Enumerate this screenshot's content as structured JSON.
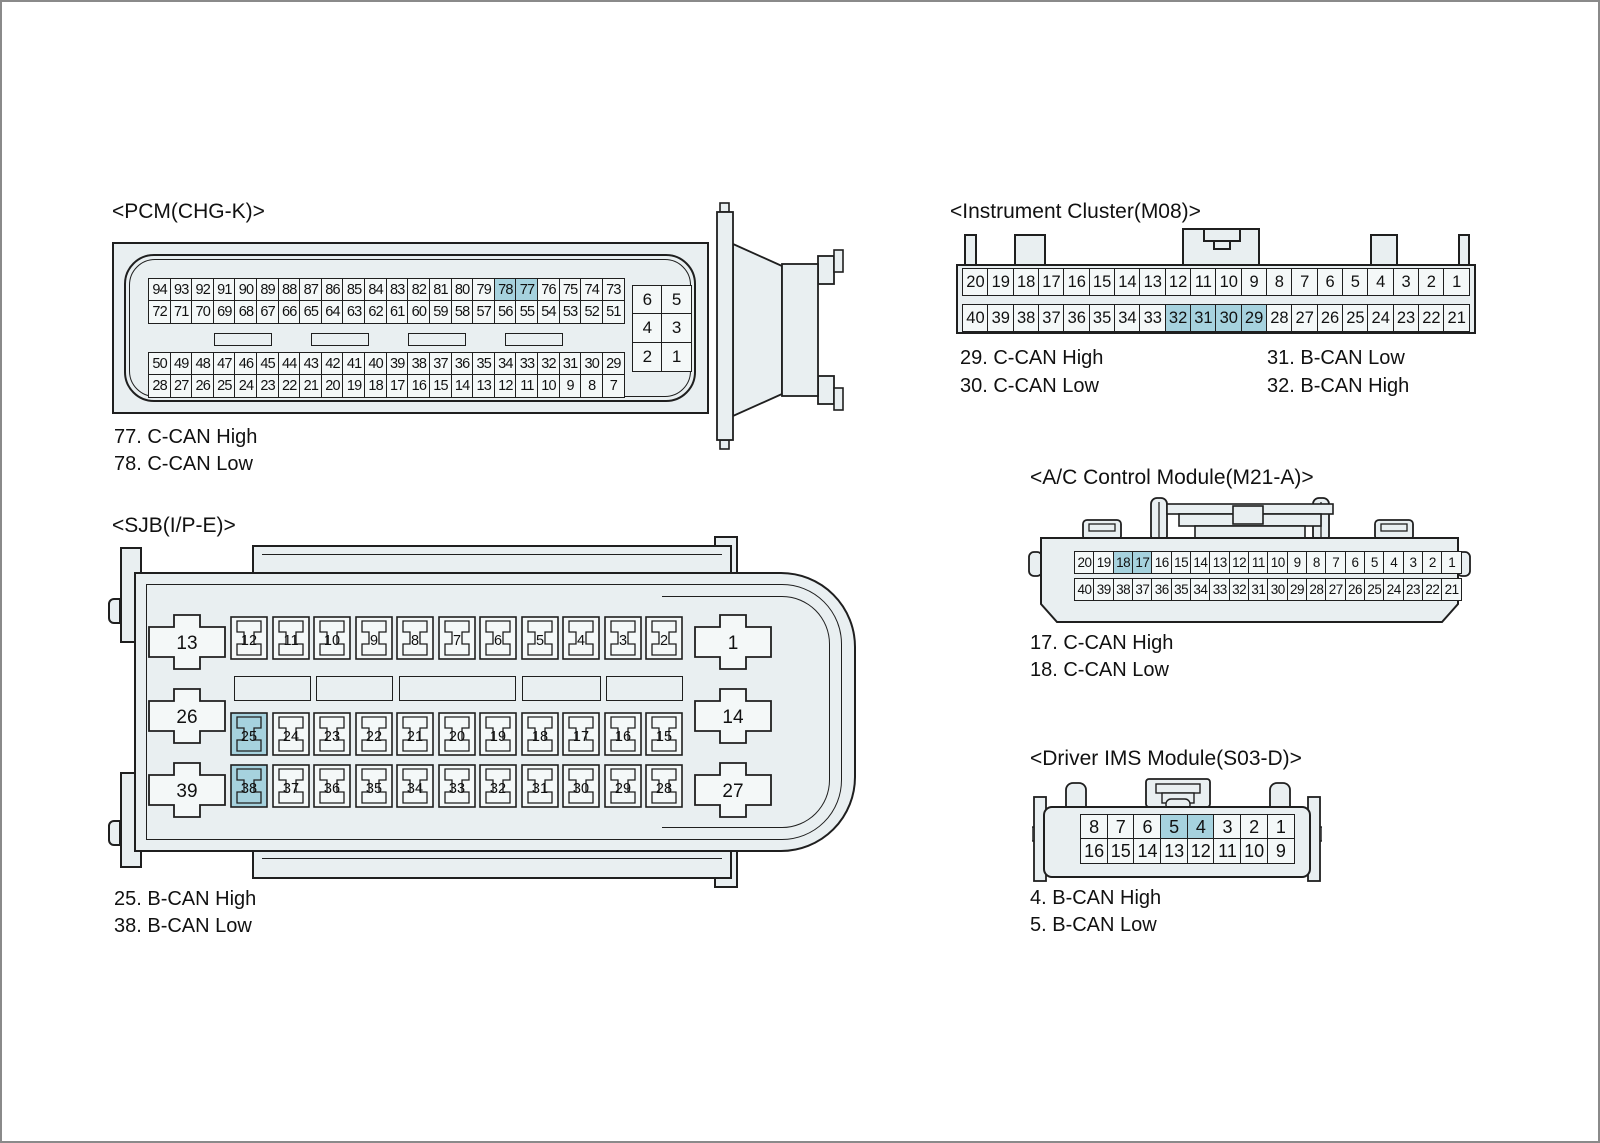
{
  "colors": {
    "body": "#e9eff1",
    "cell": "#f4f8f8",
    "hl": "#a6d2de",
    "line": "#1f1f1f",
    "frame": "#8a8a8a",
    "text": "#111111"
  },
  "pcm": {
    "title": "<PCM(CHG-K)>",
    "rows": [
      [
        94,
        93,
        92,
        91,
        90,
        89,
        88,
        87,
        86,
        85,
        84,
        83,
        82,
        81,
        80,
        79,
        78,
        77,
        76,
        75,
        74,
        73
      ],
      [
        72,
        71,
        70,
        69,
        68,
        67,
        66,
        65,
        64,
        63,
        62,
        61,
        60,
        59,
        58,
        57,
        56,
        55,
        54,
        53,
        52,
        51
      ],
      [
        50,
        49,
        48,
        47,
        46,
        45,
        44,
        43,
        42,
        41,
        40,
        39,
        38,
        37,
        36,
        35,
        34,
        33,
        32,
        31,
        30,
        29
      ],
      [
        28,
        27,
        26,
        25,
        24,
        23,
        22,
        21,
        20,
        19,
        18,
        17,
        16,
        15,
        14,
        13,
        12,
        11,
        10,
        9,
        8,
        7
      ]
    ],
    "side_rows": [
      [
        6,
        5
      ],
      [
        4,
        3
      ],
      [
        2,
        1
      ]
    ],
    "highlight": [
      78,
      77
    ],
    "notes": [
      "77. C-CAN High",
      "78. C-CAN Low"
    ]
  },
  "sjb": {
    "title": "<SJB(I/P-E)>",
    "crosses_left": [
      13,
      26,
      39
    ],
    "crosses_right": [
      1,
      14,
      27
    ],
    "row1": [
      12,
      11,
      10,
      9,
      8,
      7,
      6,
      5,
      4,
      3,
      2
    ],
    "row2": [
      25,
      24,
      23,
      22,
      21,
      20,
      19,
      18,
      17,
      16,
      15
    ],
    "row3": [
      38,
      37,
      36,
      35,
      34,
      33,
      32,
      31,
      30,
      29,
      28
    ],
    "highlight": [
      25,
      38
    ],
    "notes": [
      "25. B-CAN High",
      "38. B-CAN Low"
    ]
  },
  "cluster": {
    "title": "<Instrument Cluster(M08)>",
    "row1": [
      20,
      19,
      18,
      17,
      16,
      15,
      14,
      13,
      12,
      11,
      10,
      9,
      8,
      7,
      6,
      5,
      4,
      3,
      2,
      1
    ],
    "row2": [
      40,
      39,
      38,
      37,
      36,
      35,
      34,
      33,
      32,
      31,
      30,
      29,
      28,
      27,
      26,
      25,
      24,
      23,
      22,
      21
    ],
    "highlight": [
      32,
      31,
      30,
      29
    ],
    "notes_left": [
      "29. C-CAN High",
      "30. C-CAN Low"
    ],
    "notes_right": [
      "31. B-CAN Low",
      "32. B-CAN High"
    ]
  },
  "ac": {
    "title": "<A/C Control Module(M21-A)>",
    "row1": [
      20,
      19,
      18,
      17,
      16,
      15,
      14,
      13,
      12,
      11,
      10,
      9,
      8,
      7,
      6,
      5,
      4,
      3,
      2,
      1
    ],
    "row2": [
      40,
      39,
      38,
      37,
      36,
      35,
      34,
      33,
      32,
      31,
      30,
      29,
      28,
      27,
      26,
      25,
      24,
      23,
      22,
      21
    ],
    "highlight": [
      18,
      17
    ],
    "notes": [
      "17. C-CAN High",
      "18. C-CAN Low"
    ]
  },
  "ims": {
    "title": "<Driver IMS Module(S03-D)>",
    "row1": [
      8,
      7,
      6,
      5,
      4,
      3,
      2,
      1
    ],
    "row2": [
      16,
      15,
      14,
      13,
      12,
      11,
      10,
      9
    ],
    "highlight": [
      5,
      4
    ],
    "notes": [
      "4. B-CAN High",
      "5. B-CAN Low"
    ]
  }
}
